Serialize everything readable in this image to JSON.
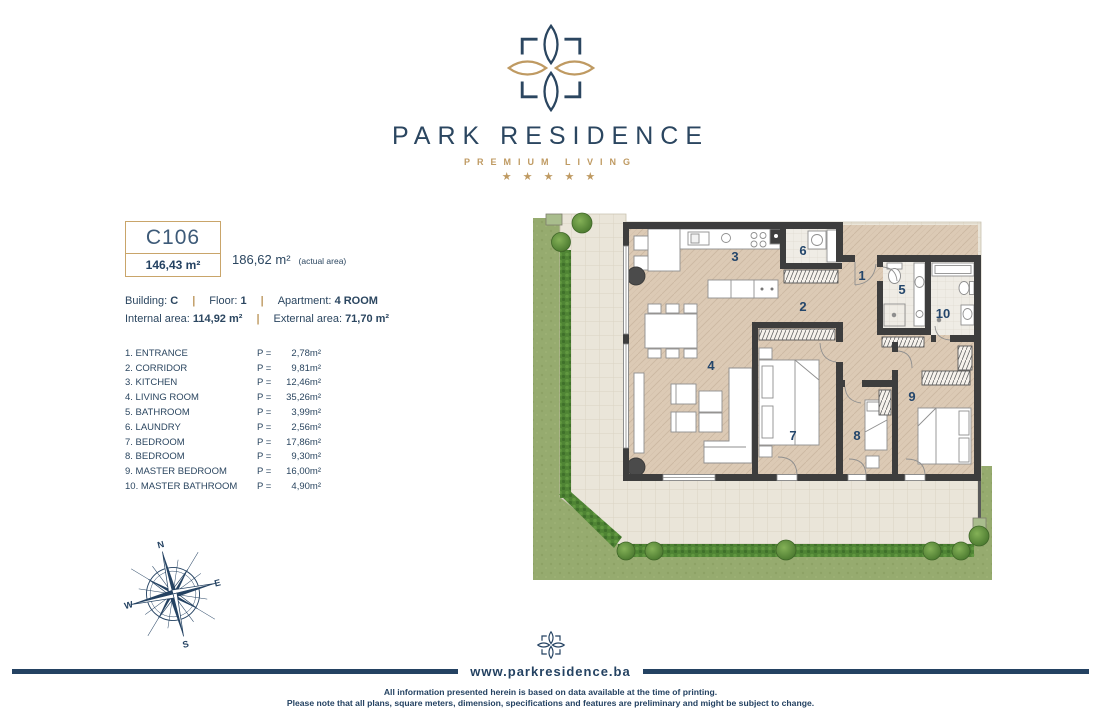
{
  "colors": {
    "navy": "#244262",
    "gold": "#bf9a62",
    "wall": "#3d3d3d",
    "lawn": "#93a96c",
    "hedge": "#4f8434",
    "terrace": "#eae5d9",
    "floor": "#dcc9b4"
  },
  "brand": {
    "name": "PARK RESIDENCE",
    "tagline": "PREMIUM LIVING",
    "stars": "★ ★ ★ ★ ★"
  },
  "unit": {
    "code": "C106",
    "area": "146,43 m²",
    "actual_area": "186,62 m²",
    "actual_area_note": "(actual area)",
    "building_label": "Building:",
    "building_value": "C",
    "floor_label": "Floor:",
    "floor_value": "1",
    "apartment_label": "Apartment:",
    "apartment_value": "4 ROOM",
    "internal_label": "Internal area:",
    "internal_value": "114,92 m²",
    "external_label": "External area:",
    "external_value": "71,70 m²",
    "separator": "|"
  },
  "room_list": {
    "p_label": "P =",
    "rows": [
      {
        "name": "1. ENTRANCE",
        "area": "2,78m²"
      },
      {
        "name": "2. CORRIDOR",
        "area": "9,81m²"
      },
      {
        "name": "3. KITCHEN",
        "area": "12,46m²"
      },
      {
        "name": "4. LIVING ROOM",
        "area": "35,26m²"
      },
      {
        "name": "5. BATHROOM",
        "area": "3,99m²"
      },
      {
        "name": "6. LAUNDRY",
        "area": "2,56m²"
      },
      {
        "name": "7. BEDROOM",
        "area": "17,86m²"
      },
      {
        "name": "8. BEDROOM",
        "area": "9,30m²"
      },
      {
        "name": "9. MASTER BEDROOM",
        "area": "16,00m²"
      },
      {
        "name": "10. MASTER BATHROOM",
        "area": "4,90m²"
      }
    ]
  },
  "plan": {
    "room_numbers": [
      "1",
      "2",
      "3",
      "4",
      "5",
      "6",
      "7",
      "8",
      "9",
      "10"
    ]
  },
  "compass": {
    "n": "N",
    "e": "E",
    "s": "S",
    "w": "W"
  },
  "footer": {
    "website": "www.parkresidence.ba",
    "line1": "All information presented herein is based on data available at the time of printing.",
    "line2": "Please note that all plans, square meters, dimension, specifications and features are preliminary and might be subject to change."
  }
}
